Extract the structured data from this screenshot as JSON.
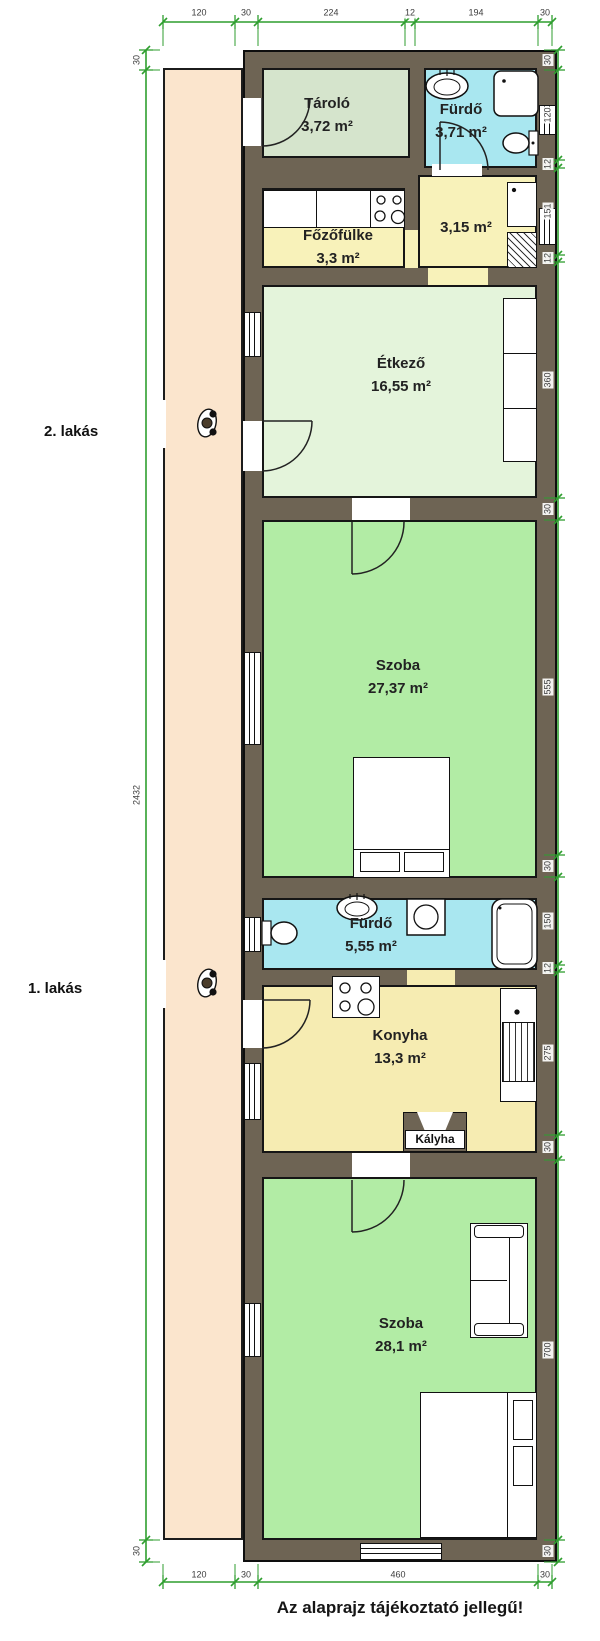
{
  "caption": "Az alaprajz tájékoztató jellegű!",
  "apartments": [
    {
      "label": "2. lakás",
      "x": 44,
      "y": 423
    },
    {
      "label": "1. lakás",
      "x": 28,
      "y": 980
    }
  ],
  "kalyha": {
    "label": "Kályha"
  },
  "colors": {
    "wall": "#6e6454",
    "veranda": "#fbe5cd",
    "dim_line": "#2f9e2f",
    "storage_room": "#d5e4cc",
    "bathroom": "#a9e7f0",
    "kitchen": "#f6ecb2",
    "dining": "#e4f4db",
    "living": "#b2eca5"
  },
  "rooms": [
    {
      "id": "tarolo",
      "name": "Tároló",
      "area": "3,72 m²",
      "x": 262,
      "y": 68,
      "w": 148,
      "h": 90,
      "fill": "#d5e4cc",
      "lx": 327,
      "ly": 92
    },
    {
      "id": "furdo-2",
      "name": "Fürdő",
      "area": "3,71 m²",
      "x": 424,
      "y": 68,
      "w": 113,
      "h": 100,
      "fill": "#a9e7f0",
      "lx": 461,
      "ly": 98
    },
    {
      "id": "fozofulke",
      "name": "Főzőfülke",
      "area": "3,3 m²",
      "x": 262,
      "y": 188,
      "w": 143,
      "h": 80,
      "fill": "#f8f2ba",
      "lx": 338,
      "ly": 224
    },
    {
      "id": "helyiseg-315",
      "name": "",
      "area": "3,15 m²",
      "x": 418,
      "y": 175,
      "w": 119,
      "h": 93,
      "fill": "#f8f2ba",
      "lx": 466,
      "ly": 216
    },
    {
      "id": "etkezo",
      "name": "Étkező",
      "area": "16,55 m²",
      "x": 262,
      "y": 285,
      "w": 275,
      "h": 213,
      "fill": "#e4f4db",
      "lx": 401,
      "ly": 352
    },
    {
      "id": "szoba-2",
      "name": "Szoba",
      "area": "27,37 m²",
      "x": 262,
      "y": 520,
      "w": 275,
      "h": 358,
      "fill": "#b2eca5",
      "lx": 398,
      "ly": 654
    },
    {
      "id": "furdo-1",
      "name": "Fürdő",
      "area": "5,55 m²",
      "x": 262,
      "y": 898,
      "w": 275,
      "h": 72,
      "fill": "#a9e7f0",
      "lx": 371,
      "ly": 912
    },
    {
      "id": "konyha",
      "name": "Konyha",
      "area": "13,3 m²",
      "x": 262,
      "y": 985,
      "w": 275,
      "h": 168,
      "fill": "#f6ecb2",
      "lx": 400,
      "ly": 1024
    },
    {
      "id": "szoba-1",
      "name": "Szoba",
      "area": "28,1 m²",
      "x": 262,
      "y": 1177,
      "w": 275,
      "h": 363,
      "fill": "#b2eca5",
      "lx": 401,
      "ly": 1312
    }
  ],
  "dims": {
    "top": [
      {
        "t": "120",
        "x": 199
      },
      {
        "t": "30",
        "x": 246
      },
      {
        "t": "224",
        "x": 331
      },
      {
        "t": "12",
        "x": 410
      },
      {
        "t": "194",
        "x": 476
      },
      {
        "t": "30",
        "x": 545
      }
    ],
    "bottom": [
      {
        "t": "120",
        "x": 199
      },
      {
        "t": "30",
        "x": 246
      },
      {
        "t": "460",
        "x": 398
      },
      {
        "t": "30",
        "x": 545
      }
    ],
    "left": [
      {
        "t": "30",
        "y": 60
      },
      {
        "t": "2432",
        "y": 795
      },
      {
        "t": "30",
        "y": 1551
      }
    ],
    "right": [
      {
        "t": "30",
        "y": 60
      },
      {
        "t": "120",
        "y": 115
      },
      {
        "t": "12",
        "y": 164
      },
      {
        "t": "151",
        "y": 211
      },
      {
        "t": "12",
        "y": 258
      },
      {
        "t": "360",
        "y": 380
      },
      {
        "t": "30",
        "y": 509
      },
      {
        "t": "555",
        "y": 687
      },
      {
        "t": "30",
        "y": 866
      },
      {
        "t": "150",
        "y": 921
      },
      {
        "t": "12",
        "y": 968
      },
      {
        "t": "275",
        "y": 1053
      },
      {
        "t": "30",
        "y": 1147
      },
      {
        "t": "700",
        "y": 1350
      },
      {
        "t": "30",
        "y": 1551
      }
    ]
  }
}
